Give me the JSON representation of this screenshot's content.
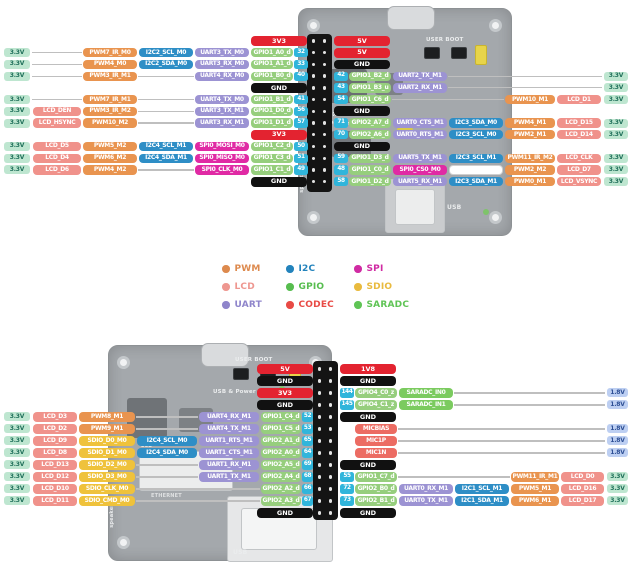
{
  "colors": {
    "pwm": "#E9944F",
    "lcd": "#F0928B",
    "uart": "#9C93D3",
    "i2c": "#2E8EC6",
    "gpio": "#96CE7D",
    "codec": "#EC6C63",
    "spi": "#E02AA4",
    "sdio": "#EFC23B",
    "saradc": "#7BCB5F",
    "power": "#E32330",
    "gnd": "#111111",
    "pin": "#30B5DB",
    "rail33_bg": "#BEE6D0",
    "rail33_text": "#20705A",
    "rail18_bg": "#BDCFF2",
    "rail18_text": "#2D4F95",
    "wire": "#BFBFBF"
  },
  "legend": {
    "items": [
      {
        "label": "PWM",
        "color": "#DD8A4E"
      },
      {
        "label": "I2C",
        "color": "#2383BC"
      },
      {
        "label": "SPI",
        "color": "#D02BA3"
      },
      {
        "label": "LCD",
        "color": "#EE9790"
      },
      {
        "label": "GPIO",
        "color": "#57BD4F"
      },
      {
        "label": "SDIO",
        "color": "#E9BA3E"
      },
      {
        "label": "UART",
        "color": "#8F85CB"
      },
      {
        "label": "CODEC",
        "color": "#E84A45"
      },
      {
        "label": "SARADC",
        "color": "#5FC455"
      }
    ]
  },
  "boards": {
    "top": {
      "user_boot": "USER BOOT",
      "brand": "LUCKFOX",
      "power_text": "USB & Power",
      "rev": "Rev2.0",
      "usb": "USB",
      "speaker": "speaker"
    },
    "bottom": {
      "user_boot": "USER BOOT",
      "power_text": "USB & Power",
      "lcd": "LCD",
      "ethernet": "ETHERNET",
      "usb": "USB",
      "speaker": "speaker"
    }
  },
  "top": {
    "left_rows": [
      {
        "power": {
          "t": "3V3",
          "k": "power"
        }
      },
      {
        "rail": "3.3V",
        "slots": [
          null,
          {
            "t": "PWM7_IR_M0",
            "k": "pwm"
          },
          {
            "t": "I2C2_SCL_M0",
            "k": "i2c"
          },
          {
            "t": "UART3_TX_M0",
            "k": "uart"
          }
        ],
        "gpio": {
          "t": "GPIO1_A0_d",
          "k": "gpio"
        },
        "pin": "32"
      },
      {
        "rail": "3.3V",
        "slots": [
          null,
          {
            "t": "PWM4_M0",
            "k": "pwm"
          },
          {
            "t": "I2C2_SDA_M0",
            "k": "i2c"
          },
          {
            "t": "UART3_RX_M0",
            "k": "uart"
          }
        ],
        "gpio": {
          "t": "GPIO1_A1_d",
          "k": "gpio"
        },
        "pin": "33"
      },
      {
        "rail": "3.3V",
        "slots": [
          null,
          {
            "t": "PWM3_IR_M1",
            "k": "pwm"
          },
          null,
          {
            "t": "UART4_RX_M0",
            "k": "uart"
          }
        ],
        "gpio": {
          "t": "GPIO1_B0_d",
          "k": "gpio"
        },
        "pin": "40"
      },
      {
        "power": {
          "t": "GND",
          "k": "gnd"
        }
      },
      {
        "rail": "3.3V",
        "slots": [
          null,
          {
            "t": "PWM7_IR_M1",
            "k": "pwm"
          },
          null,
          {
            "t": "UART4_TX_M0",
            "k": "uart"
          }
        ],
        "gpio": {
          "t": "GPIO1_B1_d",
          "k": "gpio"
        },
        "pin": "41"
      },
      {
        "rail": "3.3V",
        "slots": [
          {
            "t": "LCD_DEN",
            "k": "lcd"
          },
          {
            "t": "PWM3_IR_M2",
            "k": "pwm"
          },
          null,
          {
            "t": "UART3_TX_M1",
            "k": "uart"
          }
        ],
        "gpio": {
          "t": "GPIO1_D0_d",
          "k": "gpio"
        },
        "pin": "56"
      },
      {
        "rail": "3.3V",
        "slots": [
          {
            "t": "LCD_HSYNC",
            "k": "lcd"
          },
          {
            "t": "PWM10_M2",
            "k": "pwm"
          },
          null,
          {
            "t": "UART3_RX_M1",
            "k": "uart"
          }
        ],
        "gpio": {
          "t": "GPIO1_D1_d",
          "k": "gpio"
        },
        "pin": "57"
      },
      {
        "power": {
          "t": "3V3",
          "k": "power"
        }
      },
      {
        "rail": "3.3V",
        "slots": [
          {
            "t": "LCD_D5",
            "k": "lcd"
          },
          {
            "t": "PWM5_M2",
            "k": "pwm"
          },
          {
            "t": "I2C4_SCL_M1",
            "k": "i2c"
          },
          {
            "t": "SPI0_MOSI_M0",
            "k": "spi"
          }
        ],
        "gpio": {
          "t": "GPIO1_C2_d",
          "k": "gpio"
        },
        "pin": "50"
      },
      {
        "rail": "3.3V",
        "slots": [
          {
            "t": "LCD_D4",
            "k": "lcd"
          },
          {
            "t": "PWM6_M2",
            "k": "pwm"
          },
          {
            "t": "I2C4_SDA_M1",
            "k": "i2c"
          },
          {
            "t": "SPI0_MISO_M0",
            "k": "spi"
          }
        ],
        "gpio": {
          "t": "GPIO1_C3_d",
          "k": "gpio"
        },
        "pin": "51"
      },
      {
        "rail": "3.3V",
        "slots": [
          {
            "t": "LCD_D6",
            "k": "lcd"
          },
          {
            "t": "PWM4_M2",
            "k": "pwm"
          },
          null,
          {
            "t": "SPI0_CLK_M0",
            "k": "spi"
          }
        ],
        "gpio": {
          "t": "GPIO1_C1_d",
          "k": "gpio"
        },
        "pin": "49"
      },
      {
        "power": {
          "t": "GND",
          "k": "gnd"
        }
      }
    ],
    "right_rows": [
      {
        "power": {
          "t": "5V",
          "k": "power"
        }
      },
      {
        "power": {
          "t": "5V",
          "k": "power"
        }
      },
      {
        "power": {
          "t": "GND",
          "k": "gnd"
        }
      },
      {
        "pin": "42",
        "gpio": {
          "t": "GPIO1_B2_d",
          "k": "gpio"
        },
        "slots": [
          {
            "t": "UART2_TX_M1",
            "k": "uart"
          },
          null,
          null,
          null
        ],
        "rail": "3.3V"
      },
      {
        "pin": "43",
        "gpio": {
          "t": "GPIO1_B3_u",
          "k": "gpio"
        },
        "slots": [
          {
            "t": "UART2_RX_M1",
            "k": "uart"
          },
          null,
          null,
          null
        ],
        "rail": "3.3V"
      },
      {
        "pin": "54",
        "gpio": {
          "t": "GPIO1_C6_d",
          "k": "gpio"
        },
        "slots": [
          null,
          null,
          {
            "t": "PWM10_M1",
            "k": "pwm"
          },
          {
            "t": "LCD_D1",
            "k": "lcd"
          }
        ],
        "rail": "3.3V"
      },
      {
        "power": {
          "t": "GND",
          "k": "gnd"
        }
      },
      {
        "pin": "71",
        "gpio": {
          "t": "GPIO2_A7_d",
          "k": "gpio"
        },
        "slots": [
          {
            "t": "UART0_CTS_M1",
            "k": "uart"
          },
          {
            "t": "I2C3_SDA_M0",
            "k": "i2c"
          },
          {
            "t": "PWM4_M1",
            "k": "pwm"
          },
          {
            "t": "LCD_D15",
            "k": "lcd"
          }
        ],
        "rail": "3.3V"
      },
      {
        "pin": "70",
        "gpio": {
          "t": "GPIO2_A6_d",
          "k": "gpio"
        },
        "slots": [
          {
            "t": "UART0_RTS_M1",
            "k": "uart"
          },
          {
            "t": "I2C3_SCL_M0",
            "k": "i2c"
          },
          {
            "t": "PWM2_M1",
            "k": "pwm"
          },
          {
            "t": "LCD_D14",
            "k": "lcd"
          }
        ],
        "rail": "3.3V"
      },
      {
        "power": {
          "t": "GND",
          "k": "gnd"
        }
      },
      {
        "pin": "59",
        "gpio": {
          "t": "GPIO1_D3_d",
          "k": "gpio"
        },
        "slots": [
          {
            "t": "UART5_TX_M1",
            "k": "uart"
          },
          {
            "t": "I2C3_SCL_M1",
            "k": "i2c"
          },
          {
            "t": "PWM11_IR_M2",
            "k": "pwm"
          },
          {
            "t": "LCD_CLK",
            "k": "lcd"
          }
        ],
        "rail": "3.3V"
      },
      {
        "pin": "48",
        "gpio": {
          "t": "GPIO1_C0_d",
          "k": "gpio"
        },
        "slots": [
          {
            "t": "SPI0_CS0_M0",
            "k": "spi"
          },
          {
            "t": "",
            "k": "empty"
          },
          {
            "t": "PWM2_M2",
            "k": "pwm"
          },
          {
            "t": "LCD_D7",
            "k": "lcd"
          }
        ],
        "rail": "3.3V"
      },
      {
        "pin": "58",
        "gpio": {
          "t": "GPIO1_D2_d",
          "k": "gpio"
        },
        "slots": [
          {
            "t": "UART5_RX_M1",
            "k": "uart"
          },
          {
            "t": "I2C3_SDA_M1",
            "k": "i2c"
          },
          {
            "t": "PWM0_M1",
            "k": "pwm"
          },
          {
            "t": "LCD_VSYNC",
            "k": "lcd"
          }
        ],
        "rail": "3.3V"
      }
    ]
  },
  "bottom": {
    "left_rows": [
      {
        "power": {
          "t": "5V",
          "k": "power"
        }
      },
      {
        "power": {
          "t": "GND",
          "k": "gnd"
        }
      },
      {
        "power": {
          "t": "3V3",
          "k": "power"
        }
      },
      {
        "power": {
          "t": "GND",
          "k": "gnd"
        }
      },
      {
        "rail": "3.3V",
        "slots": [
          {
            "t": "LCD_D3",
            "k": "lcd"
          },
          {
            "t": "PWM8_M1",
            "k": "pwm"
          },
          null,
          {
            "t": "UART4_RX_M1",
            "k": "uart"
          }
        ],
        "gpio": {
          "t": "GPIO1_C4_d",
          "k": "gpio"
        },
        "pin": "52"
      },
      {
        "rail": "3.3V",
        "slots": [
          {
            "t": "LCD_D2",
            "k": "lcd"
          },
          {
            "t": "PWM9_M1",
            "k": "pwm"
          },
          null,
          {
            "t": "UART4_TX_M1",
            "k": "uart"
          }
        ],
        "gpio": {
          "t": "GPIO1_C5_d",
          "k": "gpio"
        },
        "pin": "53"
      },
      {
        "rail": "3.3V",
        "slots": [
          {
            "t": "LCD_D9",
            "k": "lcd"
          },
          {
            "t": "SDIO_D0_M0",
            "k": "sdio"
          },
          {
            "t": "I2C4_SCL_M0",
            "k": "i2c"
          },
          {
            "t": "UART1_RTS_M1",
            "k": "uart"
          }
        ],
        "gpio": {
          "t": "GPIO2_A1_d",
          "k": "gpio"
        },
        "pin": "65"
      },
      {
        "rail": "3.3V",
        "slots": [
          {
            "t": "LCD_D8",
            "k": "lcd"
          },
          {
            "t": "SDIO_D1_M0",
            "k": "sdio"
          },
          {
            "t": "I2C4_SDA_M0",
            "k": "i2c"
          },
          {
            "t": "UART1_CTS_M1",
            "k": "uart"
          }
        ],
        "gpio": {
          "t": "GPIO2_A0_d",
          "k": "gpio"
        },
        "pin": "64"
      },
      {
        "rail": "3.3V",
        "slots": [
          {
            "t": "LCD_D13",
            "k": "lcd"
          },
          {
            "t": "SDIO_D2_M0",
            "k": "sdio"
          },
          null,
          {
            "t": "UART1_RX_M1",
            "k": "uart"
          }
        ],
        "gpio": {
          "t": "GPIO2_A5_d",
          "k": "gpio"
        },
        "pin": "69"
      },
      {
        "rail": "3.3V",
        "slots": [
          {
            "t": "LCD_D12",
            "k": "lcd"
          },
          {
            "t": "SDIO_D3_M0",
            "k": "sdio"
          },
          null,
          {
            "t": "UART1_TX_M1",
            "k": "uart"
          }
        ],
        "gpio": {
          "t": "GPIO2_A4_d",
          "k": "gpio"
        },
        "pin": "68"
      },
      {
        "rail": "3.3V",
        "slots": [
          {
            "t": "LCD_D10",
            "k": "lcd"
          },
          {
            "t": "SDIO_CLK_M0",
            "k": "sdio"
          },
          null,
          null
        ],
        "gpio": {
          "t": "GPIO2_A2_d",
          "k": "gpio"
        },
        "pin": "66"
      },
      {
        "rail": "3.3V",
        "slots": [
          {
            "t": "LCD_D11",
            "k": "lcd"
          },
          {
            "t": "SDIO_CMD_M0",
            "k": "sdio"
          },
          null,
          null
        ],
        "gpio": {
          "t": "GPIO2_A3_d",
          "k": "gpio"
        },
        "pin": "67"
      },
      {
        "power": {
          "t": "GND",
          "k": "gnd"
        }
      }
    ],
    "right_rows": [
      {
        "power": {
          "t": "1V8",
          "k": "power"
        }
      },
      {
        "power": {
          "t": "GND",
          "k": "gnd"
        }
      },
      {
        "pin": "144",
        "gpio": {
          "t": "GPIO4_C0_z",
          "k": "gpio"
        },
        "slots": [
          {
            "t": "SARADC_IN0",
            "k": "saradc"
          },
          null,
          null,
          null
        ],
        "rail": "1.8V"
      },
      {
        "pin": "145",
        "gpio": {
          "t": "GPIO4_C1_z",
          "k": "gpio"
        },
        "slots": [
          {
            "t": "SARADC_IN1",
            "k": "saradc"
          },
          null,
          null,
          null
        ],
        "rail": "1.8V"
      },
      {
        "power": {
          "t": "GND",
          "k": "gnd"
        }
      },
      {
        "gpio": {
          "t": "MICBIAS",
          "k": "codec"
        },
        "slots": [
          null,
          null,
          null,
          null
        ],
        "rail": "1.8V"
      },
      {
        "gpio": {
          "t": "MIC1P",
          "k": "codec"
        },
        "slots": [
          null,
          null,
          null,
          null
        ],
        "rail": "1.8V"
      },
      {
        "gpio": {
          "t": "MIC1N",
          "k": "codec"
        },
        "slots": [
          null,
          null,
          null,
          null
        ],
        "rail": "1.8V"
      },
      {
        "power": {
          "t": "GND",
          "k": "gnd"
        }
      },
      {
        "pin": "55",
        "gpio": {
          "t": "GPIO1_C7_d",
          "k": "gpio"
        },
        "slots": [
          null,
          null,
          {
            "t": "PWM11_IR_M1",
            "k": "pwm"
          },
          {
            "t": "LCD_D0",
            "k": "lcd"
          }
        ],
        "rail": "3.3V"
      },
      {
        "pin": "72",
        "gpio": {
          "t": "GPIO2_B0_d",
          "k": "gpio"
        },
        "slots": [
          {
            "t": "UART0_RX_M1",
            "k": "uart"
          },
          {
            "t": "I2C1_SCL_M1",
            "k": "i2c"
          },
          {
            "t": "PWM5_M1",
            "k": "pwm"
          },
          {
            "t": "LCD_D16",
            "k": "lcd"
          }
        ],
        "rail": "3.3V"
      },
      {
        "pin": "73",
        "gpio": {
          "t": "GPIO2_B1_d",
          "k": "gpio"
        },
        "slots": [
          {
            "t": "UART0_TX_M1",
            "k": "uart"
          },
          {
            "t": "I2C1_SDA_M1",
            "k": "i2c"
          },
          {
            "t": "PWM6_M1",
            "k": "pwm"
          },
          {
            "t": "LCD_D17",
            "k": "lcd"
          }
        ],
        "rail": "3.3V"
      },
      {
        "power": {
          "t": "GND",
          "k": "gnd"
        }
      }
    ]
  }
}
